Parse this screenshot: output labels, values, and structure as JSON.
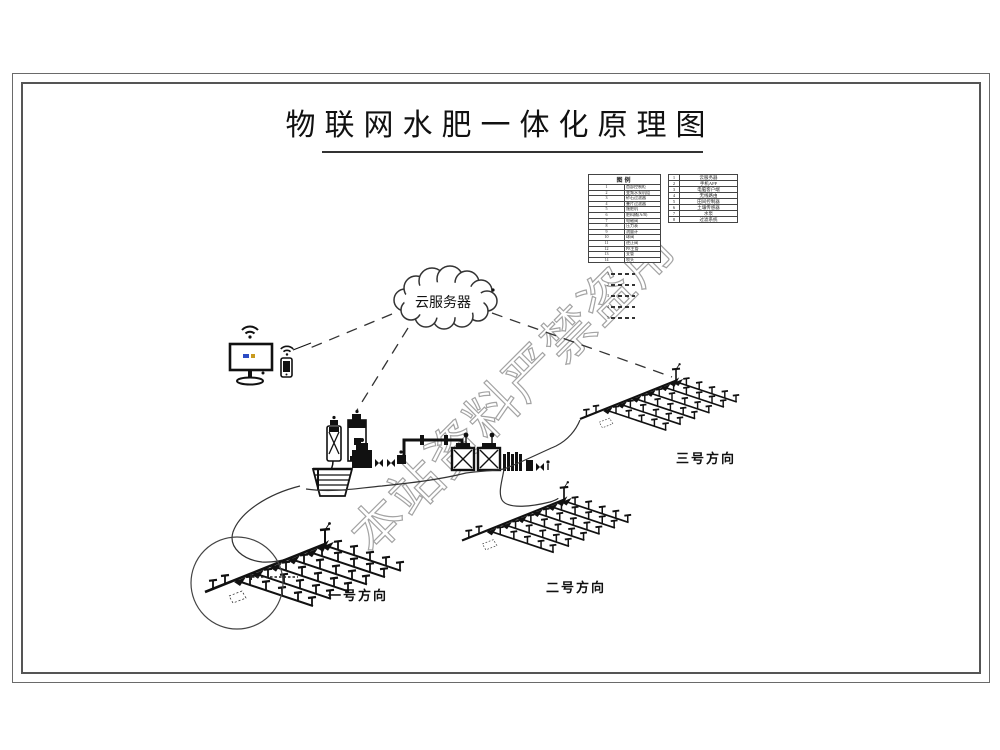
{
  "title": {
    "text": "物联网水肥一体化原理图"
  },
  "cloud": {
    "label": "云服务器"
  },
  "fields": [
    {
      "label": "一号方向"
    },
    {
      "label": "二号方向"
    },
    {
      "label": "三号方向"
    }
  ],
  "legend": {
    "left": {
      "title": "图例",
      "rows": [
        {
          "no": "1",
          "label": "首部控制柜"
        },
        {
          "no": "2",
          "label": "变频水泵机组"
        },
        {
          "no": "3",
          "label": "砂石过滤器"
        },
        {
          "no": "4",
          "label": "叠片过滤器"
        },
        {
          "no": "5",
          "label": "施肥机"
        },
        {
          "no": "6",
          "label": "肥料桶(A/B)"
        },
        {
          "no": "7",
          "label": "电磁阀"
        },
        {
          "no": "8",
          "label": "压力表"
        },
        {
          "no": "9",
          "label": "流量计"
        },
        {
          "no": "10",
          "label": "球阀"
        },
        {
          "no": "11",
          "label": "逆止阀"
        },
        {
          "no": "12",
          "label": "PE主管"
        },
        {
          "no": "13",
          "label": "支管"
        },
        {
          "no": "14",
          "label": "喷头"
        }
      ]
    },
    "right": {
      "rows": [
        {
          "no": "1",
          "label": "云服务器"
        },
        {
          "no": "2",
          "label": "手机APP"
        },
        {
          "no": "3",
          "label": "电脑客户端"
        },
        {
          "no": "4",
          "label": "无线路由"
        },
        {
          "no": "5",
          "label": "田间控制器"
        },
        {
          "no": "6",
          "label": "土壤传感器"
        },
        {
          "no": "7",
          "label": "水泵"
        },
        {
          "no": "8",
          "label": "过滤系统"
        }
      ]
    },
    "linetypes": [
      {
        "no": "1",
        "label": "干管"
      },
      {
        "no": "2",
        "label": "支管"
      },
      {
        "no": "3",
        "label": "毛管"
      },
      {
        "no": "4",
        "label": "电源线"
      },
      {
        "no": "5",
        "label": "信号线"
      }
    ]
  },
  "watermark": {
    "text": "本站资料严禁盗用"
  },
  "colors": {
    "line": "#2a2a2a",
    "watermark": "#a3a3a3",
    "background": "#ffffff"
  }
}
